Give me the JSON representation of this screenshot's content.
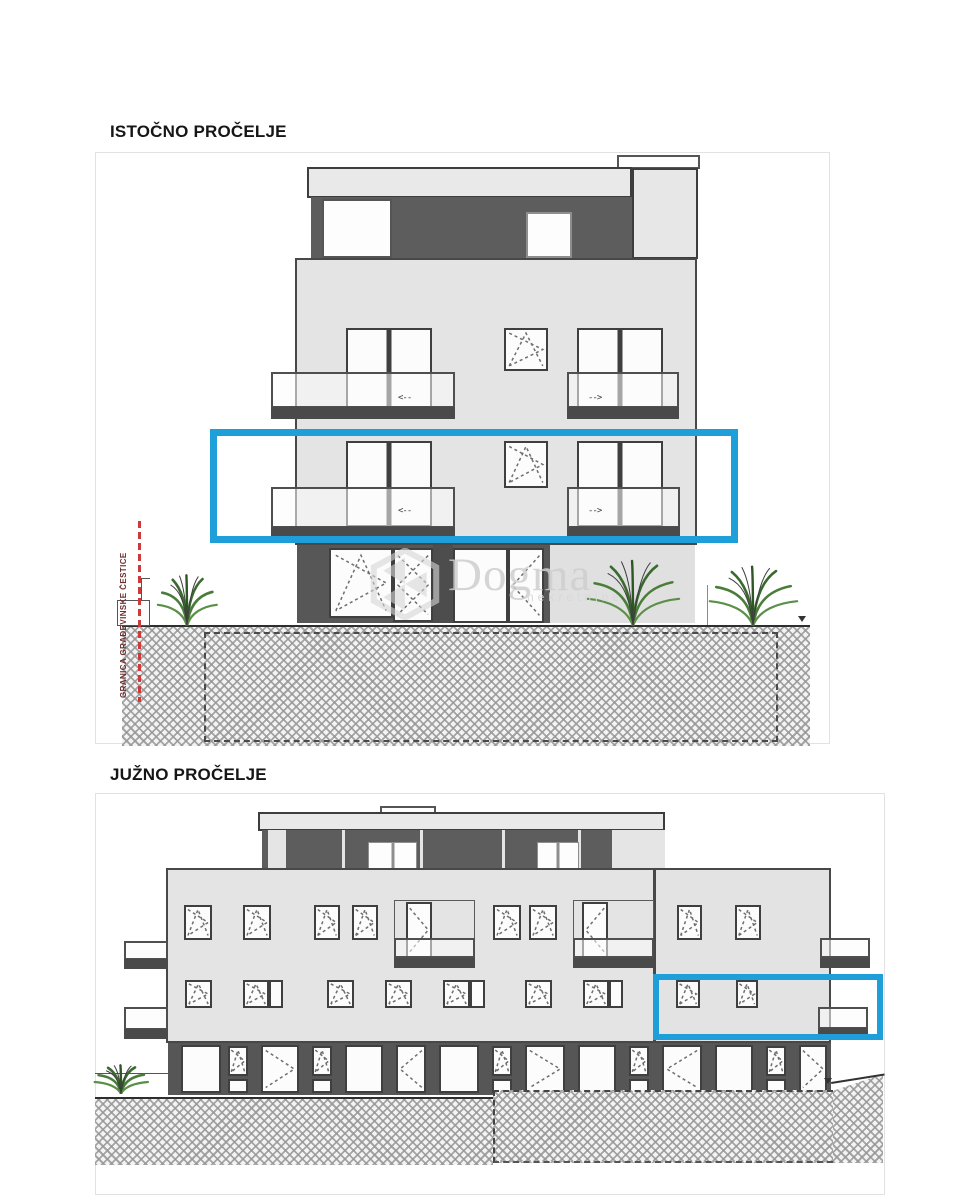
{
  "page": {
    "background": "#ffffff"
  },
  "drawings": {
    "east": {
      "title": "ISTOČNO PROČELJE"
    },
    "south": {
      "title": "JUŽNO PROČELJE"
    }
  },
  "boundary_line": {
    "label": "GRANICA GRAĐEVINSKE ČESTICE",
    "color": "#c24040"
  },
  "watermark": {
    "brand": "Dogma",
    "subtitle": "nekretnine"
  },
  "highlight": {
    "color": "#1f9fd9"
  },
  "window_arrows": {
    "left": "<--",
    "right": "-->"
  }
}
